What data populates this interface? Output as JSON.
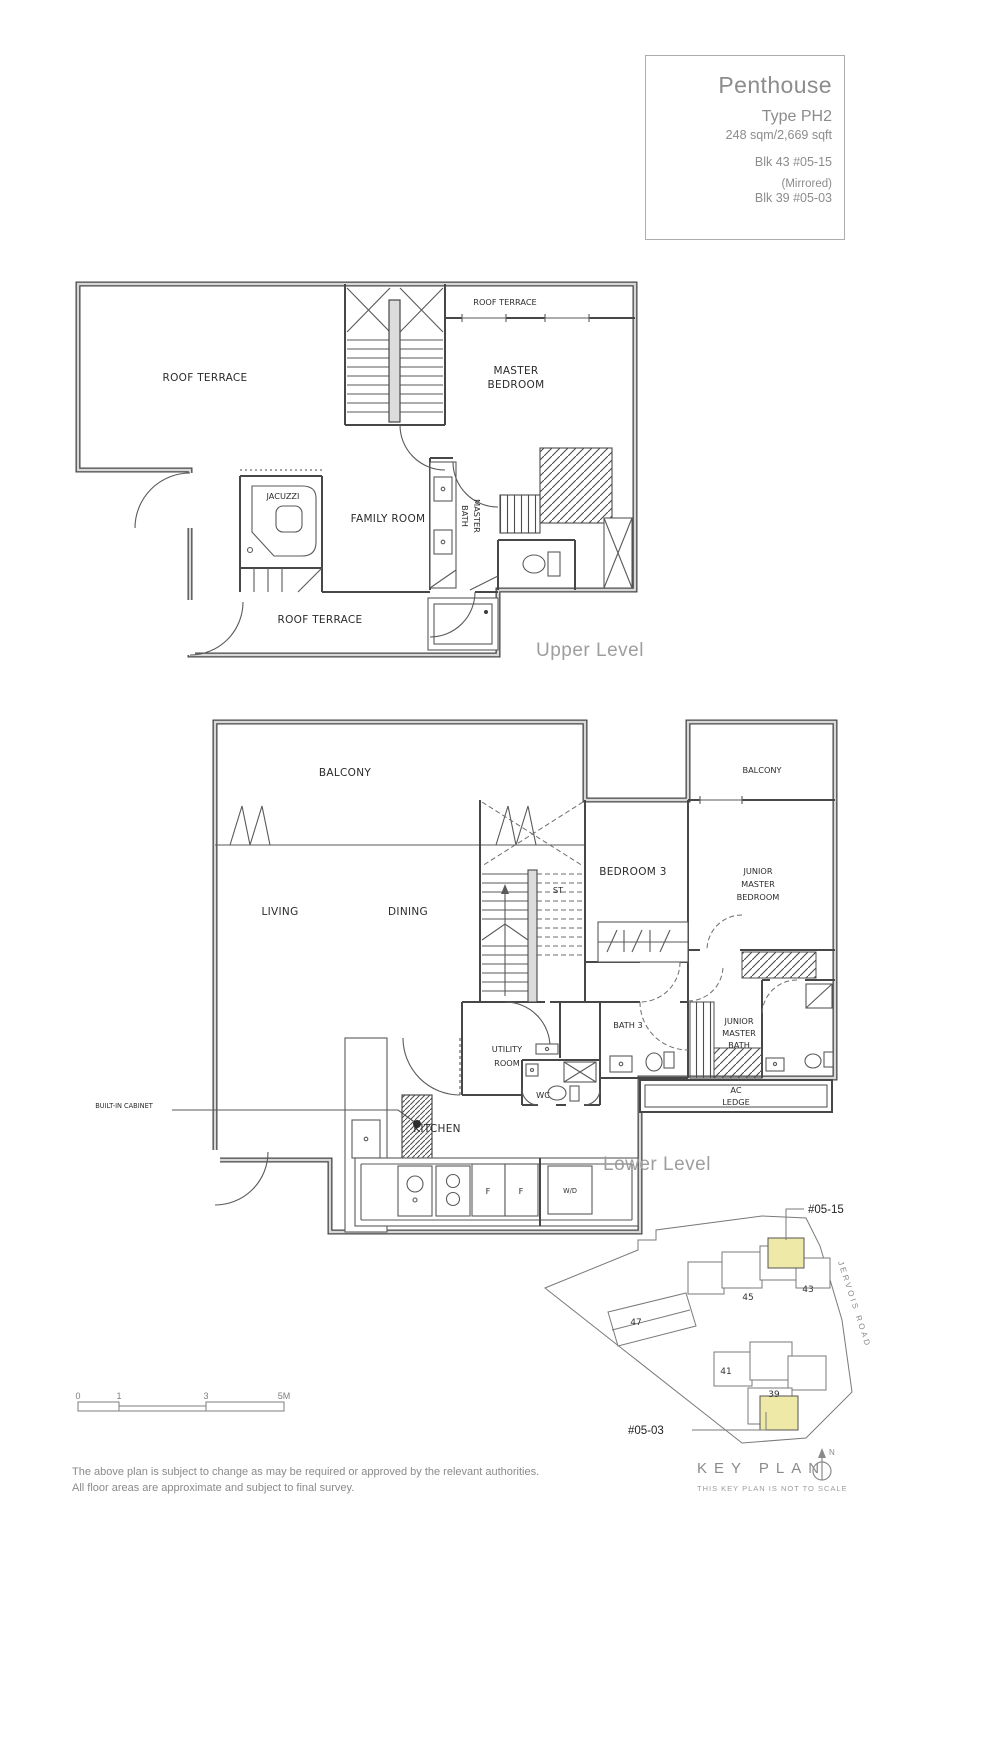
{
  "title_block": {
    "title": "Penthouse",
    "type": "Type PH2",
    "area": "248 sqm/2,669 sqft",
    "unit1": "Blk 43 #05-15",
    "mirrored": "(Mirrored)",
    "unit2": "Blk 39 #05-03"
  },
  "upper": {
    "caption": "Upper Level",
    "roof_terrace_left": "ROOF TERRACE",
    "roof_terrace_top": "ROOF TERRACE",
    "roof_terrace_bottom": "ROOF TERRACE",
    "master1": "MASTER",
    "master2": "BEDROOM",
    "jacuzzi": "JACUZZI",
    "family_room": "FAMILY ROOM",
    "mbath1": "MASTER",
    "mbath2": "BATH"
  },
  "lower": {
    "caption": "Lower Level",
    "balcony_left": "BALCONY",
    "balcony_right": "BALCONY",
    "living": "LIVING",
    "dining": "DINING",
    "st": "ST",
    "bedroom3": "BEDROOM 3",
    "jmb1": "JUNIOR",
    "jmb2": "MASTER",
    "jmb3": "BEDROOM",
    "built_in_cabinet": "BUILT-IN CABINET",
    "utility1": "UTILITY",
    "utility2": "ROOM",
    "wc": "WC",
    "bath3": "BATH 3",
    "jmbath1": "JUNIOR",
    "jmbath2": "MASTER",
    "jmbath3": "BATH",
    "ac1": "AC",
    "ac2": "LEDGE",
    "kitchen": "KITCHEN",
    "f1": "F",
    "f2": "F",
    "wd": "W/D"
  },
  "key_plan": {
    "unit_top": "#05-15",
    "unit_bottom": "#05-03",
    "road": "JERVOIS ROAD",
    "blk47": "47",
    "blk45": "45",
    "blk43": "43",
    "blk41": "41",
    "blk39": "39",
    "north": "N",
    "legend_title": "KEY PLAN",
    "legend_note": "THIS KEY PLAN IS NOT TO SCALE",
    "highlight_color": "#efe9a8"
  },
  "scale_bar": {
    "t0": "0",
    "t1": "1",
    "t3": "3",
    "t5": "5M"
  },
  "disclaimer": {
    "line1": "The above plan is subject to change as may be required or approved by the relevant authorities.",
    "line2": "All floor areas are approximate and subject to final survey."
  }
}
